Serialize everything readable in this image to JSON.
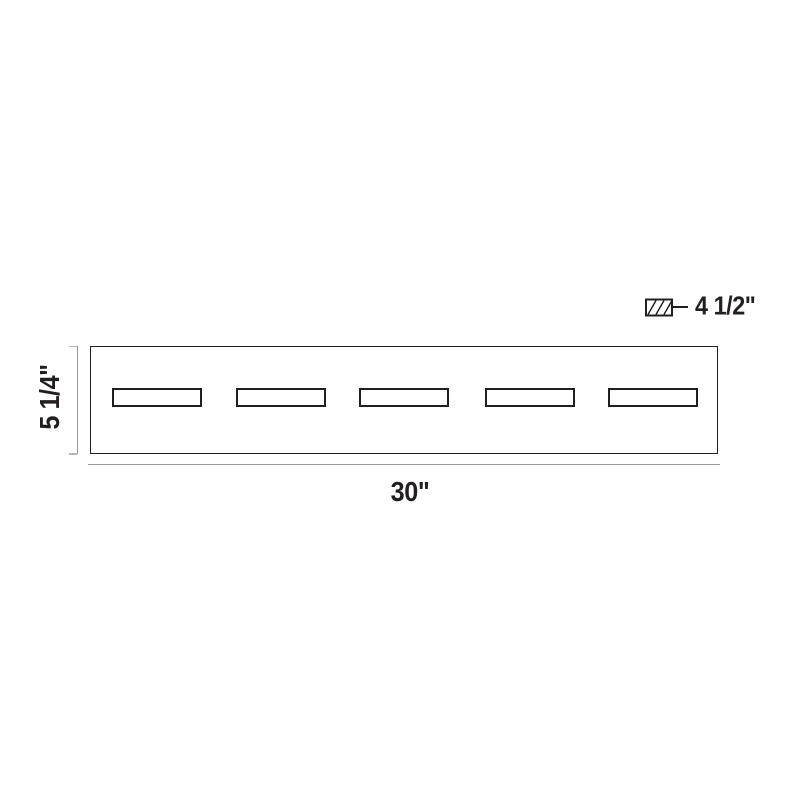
{
  "diagram": {
    "title": "Five-light vanity bar dimension drawing",
    "view": "front-elevation",
    "dimensions": {
      "width": {
        "label": "30\""
      },
      "height": {
        "label": "5 1/4\""
      },
      "depth": {
        "label": "4 1/2\""
      }
    },
    "lamps": {
      "count": 5
    },
    "colors": {
      "outline": "#231f20",
      "dimension_line": "#999999",
      "text": "#231f20",
      "background": "#ffffff"
    }
  }
}
